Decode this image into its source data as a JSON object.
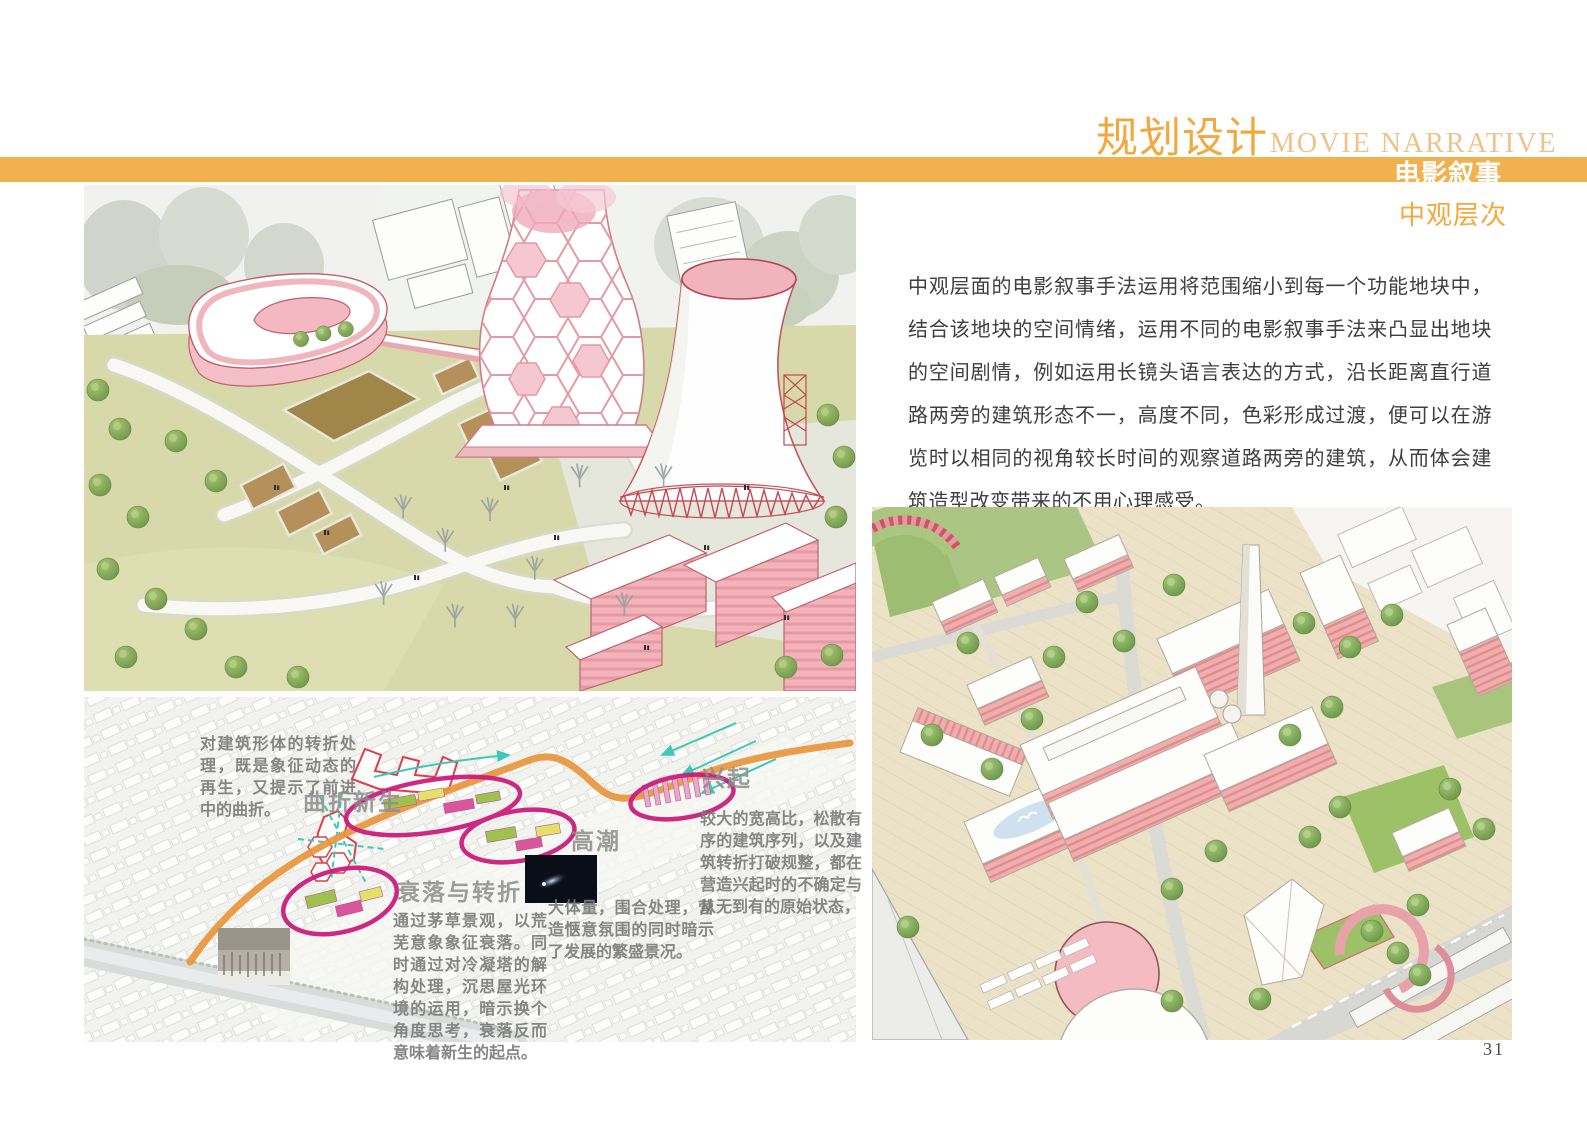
{
  "header": {
    "title_cn": "规划设计",
    "title_en": "MOVIE NARRATIVE",
    "banner_label": "电影叙事",
    "subtitle": "中观层次"
  },
  "intro": {
    "paragraph": "中观层面的电影叙事手法运用将范围缩小到每一个功能地块中，结合该地块的空间情绪，运用不同的电影叙事手法来凸显出地块的空间剧情，例如运用长镜头语言表达的方式，沿长距离直行道路两旁的建筑形态不一，高度不同，色彩形成过渡，便可以在游览时以相同的视角较长时间的观察道路两旁的建筑，从而体会建筑造型改变带来的不用心理感受。"
  },
  "diagram": {
    "labels": {
      "rebirth": "曲折新生",
      "rise": "兴起",
      "climax": "高潮",
      "decline": "衰落与转折"
    },
    "notes": {
      "rebirth": "对建筑形体的转折处理，既是象征动态的再生，又提示了前进中的曲折。",
      "rise": "较大的宽高比，松散有序的建筑序列，以及建筑转折打破规整，都在营造兴起时的不确定与从无到有的原始状态，",
      "climax": "大体量，围合处理，营造惬意氛围的同时暗示了发展的繁盛景况。",
      "decline": "通过茅草景观，以荒芜意象象征衰落。同时通过对冷凝塔的解构处理，沉思屋光环境的运用，暗示换个角度思考，衰落反而意味着新生的起点。"
    }
  },
  "footer": {
    "page_number": "31"
  },
  "colors": {
    "accent_orange": "#F3A83D",
    "banner_orange": "#F0B14E",
    "title_en_orange": "#EEC28B",
    "narrative_path_orange": "#E8953C",
    "highlight_magenta": "#CB1D7D",
    "flow_teal": "#3EC9B5",
    "building_pink": "#F2B4BC"
  }
}
